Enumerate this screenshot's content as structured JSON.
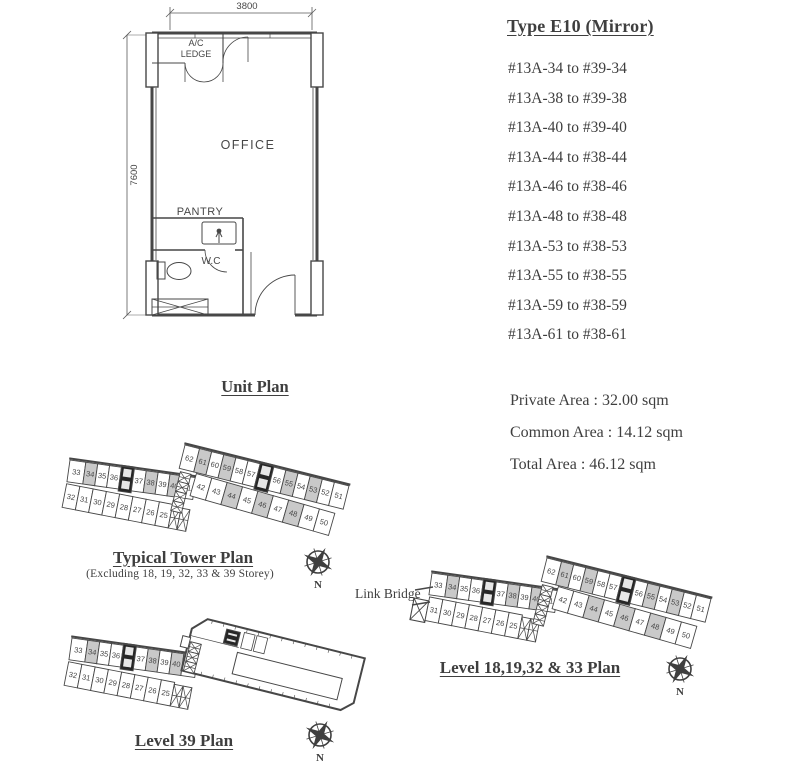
{
  "page": {
    "bg": "#ffffff",
    "ink": "#474747",
    "highlight": "#c9c9c9"
  },
  "unit_plan": {
    "title": "Unit Plan",
    "dim_width": "3800",
    "dim_height": "7600",
    "rooms": {
      "ac_ledge": "A/C LEDGE",
      "office": "OFFICE",
      "pantry": "PANTRY",
      "wc": "W.C"
    }
  },
  "type_info": {
    "title": "Type E10 (Mirror)",
    "unit_ranges": [
      "#13A-34 to #39-34",
      "#13A-38 to #39-38",
      "#13A-40 to #39-40",
      "#13A-44 to #38-44",
      "#13A-46 to #38-46",
      "#13A-48 to #38-48",
      "#13A-53 to #38-53",
      "#13A-55 to #38-55",
      "#13A-59 to #38-59",
      "#13A-61 to #38-61"
    ]
  },
  "areas": {
    "private": "Private Area : 32.00 sqm",
    "common": "Common Area : 14.12 sqm",
    "total": "Total Area : 46.12 sqm"
  },
  "plans": {
    "typical": {
      "title": "Typical Tower Plan",
      "subtitle": "(Excluding 18, 19, 32, 33 & 39 Storey)"
    },
    "level39": {
      "title": "Level 39 Plan"
    },
    "level18": {
      "title": "Level 18,19,32 & 33 Plan",
      "link_bridge": "Link Bridge"
    }
  },
  "tower_layout": {
    "left_wing_top": [
      "33",
      "34",
      "35",
      "36",
      "37",
      "38",
      "39",
      "40",
      "41"
    ],
    "left_wing_bottom": [
      "32",
      "31",
      "30",
      "29",
      "28",
      "27",
      "26",
      "25"
    ],
    "left_wing_bottom_level18": [
      "31",
      "30",
      "29",
      "28",
      "27",
      "26",
      "25"
    ],
    "right_wing_top": [
      "62",
      "61",
      "60",
      "59",
      "58",
      "57",
      "56",
      "55",
      "54",
      "53",
      "52",
      "51"
    ],
    "right_wing_bottom": [
      "42",
      "43",
      "44",
      "45",
      "46",
      "47",
      "48",
      "49",
      "50"
    ],
    "highlighted_units": [
      "34",
      "38",
      "40",
      "44",
      "46",
      "48",
      "53",
      "55",
      "59",
      "61"
    ]
  },
  "compass": {
    "label": "N"
  }
}
